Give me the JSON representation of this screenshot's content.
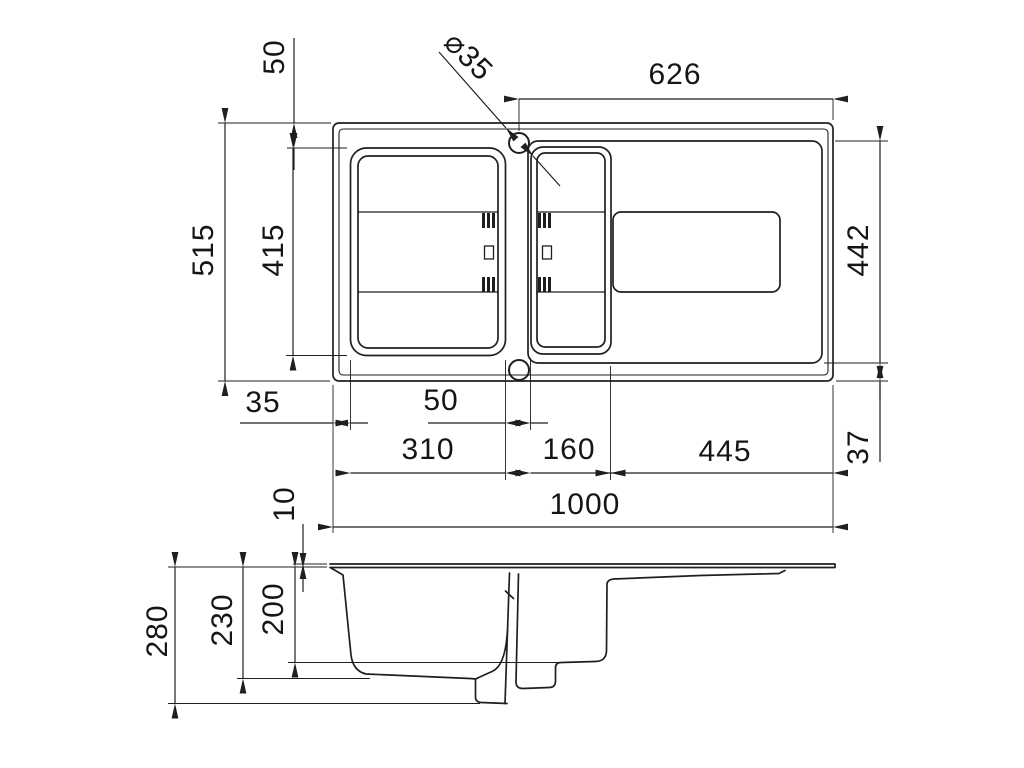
{
  "drawing": {
    "type": "technical dimension drawing",
    "subject": "kitchen sink with one and a half bowls and drainer - plan view and section view",
    "units": "mm"
  },
  "dims": {
    "top_margin": "50",
    "faucet_hole_diameter": "⌀35",
    "right_section_width": "626",
    "overall_depth": "515",
    "main_bowl_length": "415",
    "inner_length": "442",
    "left_margin": "35",
    "bowl_gap": "50",
    "main_bowl_width": "310",
    "small_bowl_width": "160",
    "drainer_width": "445",
    "bottom_margin": "37",
    "overall_width": "1000",
    "rim_height": "10",
    "overall_height": "280",
    "main_bowl_depth": "230",
    "small_bowl_depth": "200"
  },
  "colors": {
    "line": "#1f1f1f",
    "background": "#ffffff"
  }
}
